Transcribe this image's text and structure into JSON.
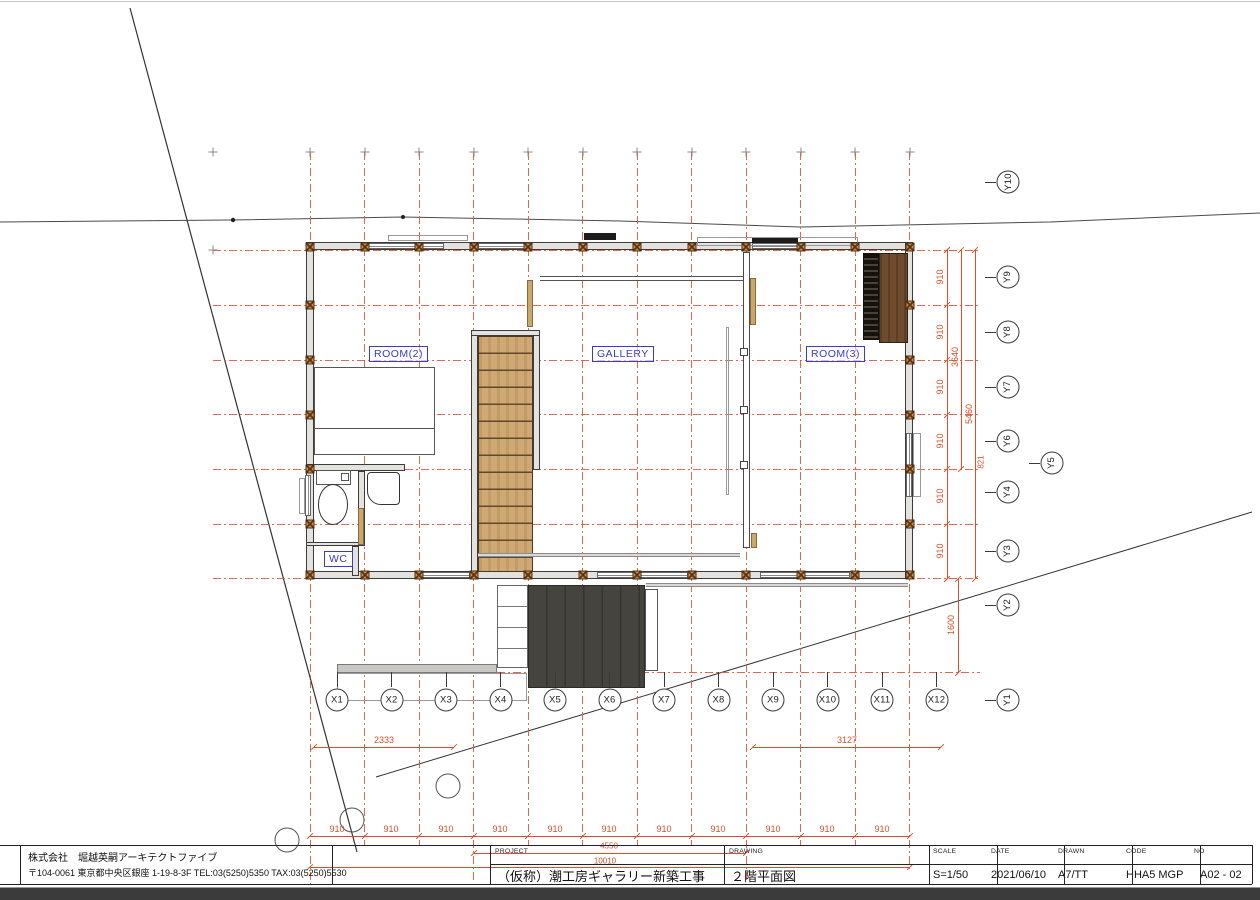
{
  "title_block": {
    "company_line1": "株式会社　堀越英嗣アーキテクトファイブ",
    "company_line2": "〒104-0061 東京都中央区銀座 1-19-8-3F TEL:03(5250)5350 TAX:03(5250)5530",
    "project_label": "PROJECT",
    "project_value": "（仮称）潮工房ギャラリー新築工事",
    "drawing_label": "DRAWING",
    "drawing_value": "２階平面図",
    "scale_label": "SCALE",
    "scale_value": "S=1/50",
    "date_label": "DATE",
    "date_value": "2021/06/10",
    "drawn_label": "DRAWN",
    "drawn_value": "A7/TT",
    "code_label": "CODE",
    "code_value": "HHA5 MGP",
    "no_label": "NO",
    "no_value": "A02 - 02"
  },
  "rooms": {
    "room2": "ROOM(2)",
    "gallery": "GALLERY",
    "room3": "ROOM(3)",
    "wc": "WC"
  },
  "colors": {
    "grid_red": "#e0553a",
    "dim_red": "#d94f2b",
    "label_blue": "#3a3acb"
  },
  "plan": {
    "x_lines": [
      {
        "x": 310,
        "y1": 152,
        "y2": 884
      },
      {
        "x": 364.5,
        "y1": 152,
        "y2": 845
      },
      {
        "x": 419,
        "y1": 152,
        "y2": 845
      },
      {
        "x": 473.5,
        "y1": 152,
        "y2": 880
      },
      {
        "x": 528,
        "y1": 152,
        "y2": 845
      },
      {
        "x": 582.5,
        "y1": 152,
        "y2": 845
      },
      {
        "x": 637,
        "y1": 152,
        "y2": 845
      },
      {
        "x": 691.5,
        "y1": 152,
        "y2": 845
      },
      {
        "x": 746,
        "y1": 152,
        "y2": 880
      },
      {
        "x": 800.5,
        "y1": 152,
        "y2": 845
      },
      {
        "x": 855,
        "y1": 152,
        "y2": 845
      },
      {
        "x": 909.5,
        "y1": 152,
        "y2": 870
      }
    ],
    "y_lines": [
      {
        "y": 250,
        "x1": 213,
        "x2": 980
      },
      {
        "y": 305,
        "x1": 213,
        "x2": 980
      },
      {
        "y": 360,
        "x1": 213,
        "x2": 980
      },
      {
        "y": 414.5,
        "x1": 213,
        "x2": 980
      },
      {
        "y": 469,
        "x1": 213,
        "x2": 980
      },
      {
        "y": 524,
        "x1": 213,
        "x2": 980
      },
      {
        "y": 578.5,
        "x1": 213,
        "x2": 980
      },
      {
        "y": 672.5,
        "x1": 337,
        "x2": 980
      }
    ],
    "x_bubbles": [
      {
        "label": "X1",
        "x": 337
      },
      {
        "label": "X2",
        "x": 391.5
      },
      {
        "label": "X3",
        "x": 446
      },
      {
        "label": "X4",
        "x": 500.5
      },
      {
        "label": "X5",
        "x": 555
      },
      {
        "label": "X6",
        "x": 609.5
      },
      {
        "label": "X7",
        "x": 664
      },
      {
        "label": "X8",
        "x": 718.5
      },
      {
        "label": "X9",
        "x": 773
      },
      {
        "label": "X10",
        "x": 827.5
      },
      {
        "label": "X11",
        "x": 882
      },
      {
        "label": "X12",
        "x": 936.5
      }
    ],
    "x_bubble_y": 700,
    "y_bubbles": [
      {
        "label": "Y10",
        "y": 182
      },
      {
        "label": "Y9",
        "y": 277
      },
      {
        "label": "Y8",
        "y": 332
      },
      {
        "label": "Y7",
        "y": 387
      },
      {
        "label": "Y6",
        "y": 441
      },
      {
        "label": "Y5",
        "y": 463,
        "x": 1052
      },
      {
        "label": "Y4",
        "y": 492
      },
      {
        "label": "Y3",
        "y": 551
      },
      {
        "label": "Y2",
        "y": 605
      },
      {
        "label": "Y1",
        "y": 700
      }
    ],
    "y_bubble_x": 1008,
    "wall_post_ys": [
      305,
      360,
      414.5,
      469,
      524
    ],
    "dim_texts": [
      {
        "t": "910",
        "x": 337,
        "y": 829
      },
      {
        "t": "910",
        "x": 391,
        "y": 829
      },
      {
        "t": "910",
        "x": 446,
        "y": 829
      },
      {
        "t": "910",
        "x": 500,
        "y": 829
      },
      {
        "t": "910",
        "x": 555,
        "y": 829
      },
      {
        "t": "910",
        "x": 609,
        "y": 829
      },
      {
        "t": "910",
        "x": 664,
        "y": 829
      },
      {
        "t": "910",
        "x": 718,
        "y": 829
      },
      {
        "t": "910",
        "x": 773,
        "y": 829
      },
      {
        "t": "910",
        "x": 827,
        "y": 829
      },
      {
        "t": "910",
        "x": 882,
        "y": 829
      },
      {
        "t": "2333",
        "x": 384,
        "y": 740
      },
      {
        "t": "3127",
        "x": 847,
        "y": 740
      },
      {
        "t": "4550",
        "x": 609,
        "y": 846,
        "s": 8
      },
      {
        "t": "10010",
        "x": 605,
        "y": 861,
        "s": 8
      },
      {
        "t": "910",
        "x": 940,
        "y": 277,
        "r": 1
      },
      {
        "t": "910",
        "x": 940,
        "y": 332,
        "r": 1
      },
      {
        "t": "910",
        "x": 940,
        "y": 387,
        "r": 1
      },
      {
        "t": "910",
        "x": 940,
        "y": 441,
        "r": 1
      },
      {
        "t": "910",
        "x": 940,
        "y": 496,
        "r": 1
      },
      {
        "t": "910",
        "x": 940,
        "y": 551,
        "r": 1
      },
      {
        "t": "3640",
        "x": 955,
        "y": 357,
        "r": 1
      },
      {
        "t": "5460",
        "x": 969,
        "y": 414,
        "r": 1
      },
      {
        "t": "1600",
        "x": 951,
        "y": 625,
        "r": 1
      },
      {
        "t": "821",
        "x": 981,
        "y": 462,
        "r": 1,
        "s": 8
      }
    ],
    "dim_lines": [
      [
        310,
        836,
        600,
        1
      ],
      [
        314,
        747,
        140,
        1
      ],
      [
        753,
        747,
        188,
        1
      ],
      [
        473.5,
        853,
        272.5,
        1
      ],
      [
        310,
        867,
        600,
        1
      ],
      [
        947,
        250,
        1,
        328.5
      ],
      [
        961,
        250,
        1,
        219
      ],
      [
        975,
        250,
        1,
        328.5
      ],
      [
        958,
        578.5,
        1,
        94
      ]
    ],
    "extra_ticks": [
      [
        314,
        747
      ],
      [
        454,
        747
      ],
      [
        753,
        747
      ],
      [
        941,
        747
      ],
      [
        473.5,
        853
      ],
      [
        746,
        853
      ],
      [
        310,
        867
      ],
      [
        909.5,
        867
      ],
      [
        961,
        250
      ],
      [
        961,
        469
      ],
      [
        975,
        250
      ],
      [
        975,
        578.5
      ],
      [
        958,
        578.5
      ],
      [
        958,
        672.5
      ],
      [
        947,
        250
      ],
      [
        947,
        578.5
      ]
    ],
    "walls": [
      {
        "c": "wall",
        "x": 306,
        "y": 242,
        "w": 607,
        "h": 8
      },
      {
        "c": "wall",
        "x": 306,
        "y": 570.5,
        "w": 607,
        "h": 8
      },
      {
        "c": "wall",
        "x": 306,
        "y": 242,
        "w": 8,
        "h": 336
      },
      {
        "c": "wall",
        "x": 905,
        "y": 242,
        "w": 8,
        "h": 336
      },
      {
        "c": "wall",
        "x": 306,
        "y": 464,
        "w": 99,
        "h": 7
      },
      {
        "c": "wall",
        "x": 358,
        "y": 471,
        "w": 7,
        "h": 75
      },
      {
        "c": "wall",
        "x": 306,
        "y": 542,
        "w": 53,
        "h": 4
      },
      {
        "c": "wall",
        "x": 352,
        "y": 546,
        "w": 7,
        "h": 30
      },
      {
        "c": "wall",
        "x": 471,
        "y": 330,
        "w": 7,
        "h": 248
      },
      {
        "c": "wall",
        "x": 533,
        "y": 330,
        "w": 7,
        "h": 140
      },
      {
        "c": "wall",
        "x": 471,
        "y": 330,
        "w": 69,
        "h": 6
      },
      {
        "c": "wall-light",
        "x": 743,
        "y": 252,
        "w": 7,
        "h": 296
      },
      {
        "c": "win",
        "x": 368,
        "y": 243,
        "w": 76,
        "h": 6
      },
      {
        "c": "win",
        "x": 478,
        "y": 243,
        "w": 48,
        "h": 6
      },
      {
        "c": "win",
        "x": 752,
        "y": 243,
        "w": 46,
        "h": 6
      },
      {
        "c": "win",
        "x": 421,
        "y": 571.5,
        "w": 49,
        "h": 6
      },
      {
        "c": "win",
        "x": 597,
        "y": 571.5,
        "w": 91,
        "h": 6
      },
      {
        "c": "win",
        "x": 760,
        "y": 571.5,
        "w": 90,
        "h": 6
      },
      {
        "c": "win winv",
        "x": 305,
        "y": 475,
        "w": 6,
        "h": 41
      },
      {
        "c": "win winv",
        "x": 906,
        "y": 433,
        "w": 6,
        "h": 64
      },
      {
        "c": "outline-light",
        "x": 299,
        "y": 478,
        "w": 6,
        "h": 36
      },
      {
        "c": "outline-light",
        "x": 913,
        "y": 433,
        "w": 8,
        "h": 64
      }
    ],
    "structures": [
      {
        "c": "outline",
        "x": 314,
        "y": 367,
        "w": 121,
        "h": 88
      },
      {
        "c": "hline",
        "x": 314,
        "y": 428,
        "w": 121,
        "h": 1
      },
      {
        "c": "treads",
        "x": 478,
        "y": 336,
        "w": 55,
        "h": 236
      },
      {
        "c": "deck",
        "x": 528,
        "y": 585,
        "w": 117,
        "h": 103
      },
      {
        "c": "outline",
        "x": 645,
        "y": 589,
        "w": 13,
        "h": 82
      },
      {
        "c": "steps",
        "x": 497,
        "y": 585,
        "w": 31,
        "h": 83
      },
      {
        "c": "strip",
        "x": 337,
        "y": 664,
        "w": 160,
        "h": 9
      },
      {
        "c": "outline-light",
        "x": 337,
        "y": 673,
        "w": 190,
        "h": 28
      },
      {
        "c": "ladder",
        "x": 863,
        "y": 253,
        "w": 16,
        "h": 87
      },
      {
        "c": "wood",
        "x": 879,
        "y": 253,
        "w": 29,
        "h": 90
      },
      {
        "c": "outline",
        "x": 316,
        "y": 470,
        "w": 35,
        "h": 15
      },
      {
        "c": "outline",
        "x": 341,
        "y": 473,
        "w": 8,
        "h": 8
      },
      {
        "c": "bowl",
        "x": 318,
        "y": 484,
        "w": 30,
        "h": 41
      },
      {
        "c": "basin",
        "x": 367,
        "y": 472,
        "w": 33,
        "h": 33
      },
      {
        "c": "tanpost",
        "x": 527,
        "y": 280,
        "w": 6,
        "h": 47
      },
      {
        "c": "tanpost",
        "x": 750,
        "y": 278,
        "w": 6,
        "h": 47
      },
      {
        "c": "tanpost",
        "x": 751,
        "y": 533,
        "w": 6,
        "h": 15
      },
      {
        "c": "tanpost",
        "x": 358,
        "y": 508,
        "w": 6,
        "h": 37
      },
      {
        "c": "hline",
        "x": 540,
        "y": 276,
        "w": 203,
        "h": 1
      },
      {
        "c": "hline",
        "x": 540,
        "y": 280,
        "w": 203,
        "h": 1
      },
      {
        "c": "track",
        "x": 478,
        "y": 553,
        "w": 262,
        "h": 4
      },
      {
        "c": "track",
        "x": 646,
        "y": 583,
        "w": 262,
        "h": 4
      },
      {
        "c": "outline-light",
        "x": 388,
        "y": 235,
        "w": 80,
        "h": 6
      },
      {
        "c": "outline-light",
        "x": 697,
        "y": 237,
        "w": 161,
        "h": 9
      },
      {
        "c": "blackbar",
        "x": 584,
        "y": 233,
        "w": 32,
        "h": 7
      },
      {
        "c": "blackbar",
        "x": 752,
        "y": 238,
        "w": 46,
        "h": 5
      },
      {
        "c": "outline-light",
        "x": 726,
        "y": 327,
        "w": 3,
        "h": 168
      },
      {
        "c": "sq",
        "x": 740,
        "y": 348,
        "w": 8,
        "h": 8
      },
      {
        "c": "sq",
        "x": 740,
        "y": 406,
        "w": 8,
        "h": 8
      },
      {
        "c": "sq",
        "x": 740,
        "y": 461,
        "w": 8,
        "h": 8
      }
    ],
    "room_labels": [
      {
        "key": "room2",
        "x": 369,
        "y": 346
      },
      {
        "key": "gallery",
        "x": 592,
        "y": 346
      },
      {
        "key": "room3",
        "x": 806,
        "y": 346
      },
      {
        "key": "wc",
        "x": 324,
        "y": 551
      }
    ],
    "tb_cols": [
      20,
      332,
      490,
      724,
      929,
      997,
      1064,
      1132,
      1200,
      1252
    ]
  }
}
